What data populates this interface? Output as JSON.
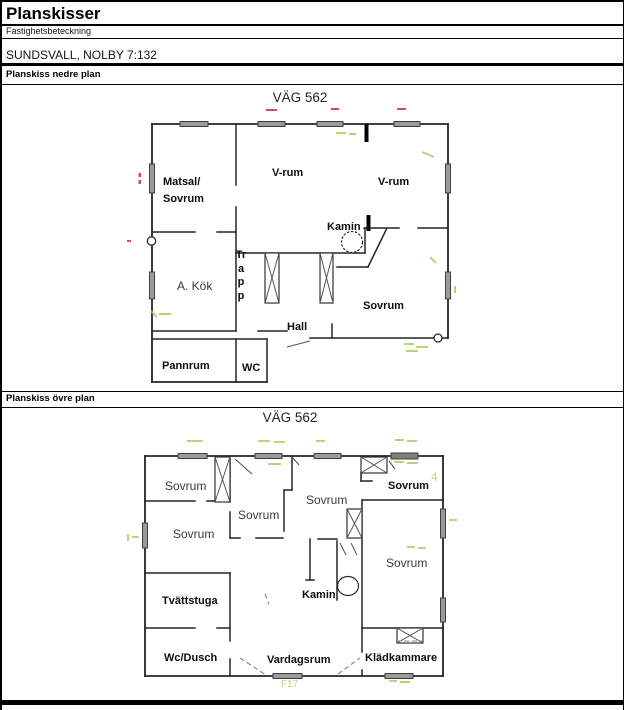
{
  "header": {
    "title": "Planskisser",
    "property_label": "Fastighetsbeteckning",
    "property_value": "SUNDSVALL, NOLBY 7:132",
    "section_lower": "Planskiss nedre plan",
    "section_upper": "Planskiss övre plan"
  },
  "floor1": {
    "title": "VÄG 562",
    "rooms": {
      "matsal_line1": "Matsal/",
      "matsal_line2": "Sovrum",
      "vrum_center": "V-rum",
      "vrum_right": "V-rum",
      "kamin": "Kamin",
      "kok": "A. Kök",
      "trapp": "Trapp",
      "sovrum": "Sovrum",
      "hall": "Hall",
      "pannrum": "Pannrum",
      "wc": "WC"
    }
  },
  "floor2": {
    "title": "VÄG 562",
    "rooms": {
      "sovrum_nw": "Sovrum",
      "sovrum_w": "Sovrum",
      "sovrum_mid": "Sovrum",
      "sovrum_ctop": "Sovrum",
      "sovrum_ne": "Sovrum",
      "sovrum_e": "Sovrum",
      "tvattstuga": "Tvättstuga",
      "kamin": "Kamin",
      "wc_dusch": "Wc/Dusch",
      "vardagsrum": "Vardagsrum",
      "kladkammare": "Klädkammare"
    }
  },
  "faint_annotations": {
    "f17": "F17",
    "four": "4"
  },
  "colors": {
    "wall": "#242424",
    "window": "#9a9a9a",
    "window_dark": "#7e7e7e",
    "green": "#a6cf63",
    "red": "#cf3b3b"
  }
}
